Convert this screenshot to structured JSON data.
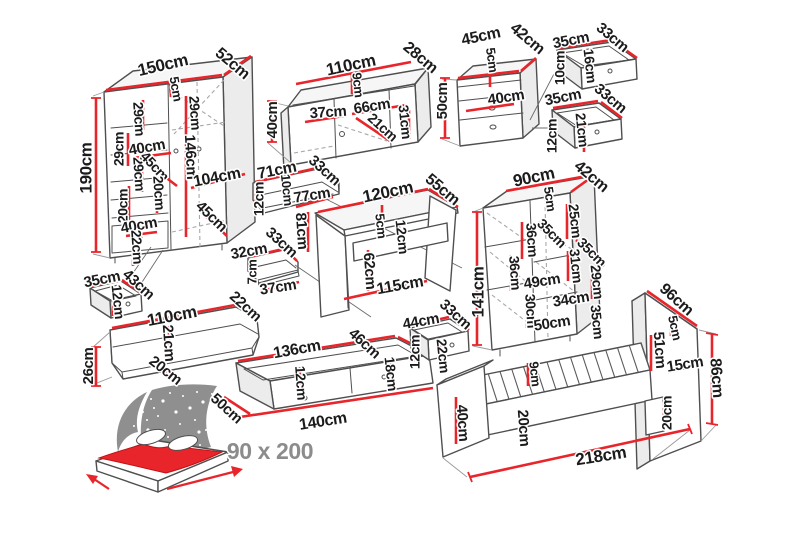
{
  "title": "Bedroom furniture set dimension diagram",
  "label_style": {
    "color": "#1b1b1b",
    "size": 15
  },
  "colors": {
    "dimension_red": "#e8252b",
    "outline": "#4f4f4f",
    "hidden_dash": "#a8a8a8",
    "star_panel": "#8f8f8f",
    "blanket_red": "#e8252b",
    "size_label_gray": "#8c8c8c",
    "background": "#ffffff"
  },
  "bed_icon": {
    "size_label": "90 x 200"
  },
  "pieces": [
    {
      "id": "wardrobe",
      "labels": [
        {
          "t": "150cm",
          "x": 163,
          "y": 66,
          "r": -13,
          "s": 17
        },
        {
          "t": "52cm",
          "x": 232,
          "y": 64,
          "r": 40,
          "s": 16
        },
        {
          "t": "5cm",
          "x": 175,
          "y": 89,
          "r": 80,
          "s": 13
        },
        {
          "t": "29cm",
          "x": 138,
          "y": 119,
          "r": 86,
          "s": 14
        },
        {
          "t": "29cm",
          "x": 194,
          "y": 113,
          "r": 86,
          "s": 14
        },
        {
          "t": "190cm",
          "x": 87,
          "y": 168,
          "r": -90,
          "s": 17
        },
        {
          "t": "29cm",
          "x": 120,
          "y": 149,
          "r": -90,
          "s": 14
        },
        {
          "t": "40cm",
          "x": 147,
          "y": 148,
          "r": -10,
          "s": 15
        },
        {
          "t": "29cm",
          "x": 138,
          "y": 174,
          "r": 86,
          "s": 14
        },
        {
          "t": "45cm",
          "x": 154,
          "y": 167,
          "r": 47,
          "s": 14
        },
        {
          "t": "20cm",
          "x": 158,
          "y": 193,
          "r": 86,
          "s": 14
        },
        {
          "t": "20cm",
          "x": 124,
          "y": 206,
          "r": -90,
          "s": 14
        },
        {
          "t": "146cm",
          "x": 190,
          "y": 157,
          "r": 87,
          "s": 15
        },
        {
          "t": "104cm",
          "x": 217,
          "y": 178,
          "r": -11,
          "s": 16
        },
        {
          "t": "40cm",
          "x": 139,
          "y": 226,
          "r": -10,
          "s": 15
        },
        {
          "t": "45cm",
          "x": 211,
          "y": 217,
          "r": 44,
          "s": 15
        },
        {
          "t": "22cm",
          "x": 136,
          "y": 247,
          "r": 86,
          "s": 14
        }
      ]
    },
    {
      "id": "tv-stand",
      "labels": [
        {
          "t": "110cm",
          "x": 351,
          "y": 66,
          "r": -12,
          "s": 17
        },
        {
          "t": "28cm",
          "x": 420,
          "y": 58,
          "r": 40,
          "s": 16
        },
        {
          "t": "40cm",
          "x": 273,
          "y": 120,
          "r": -90,
          "s": 15
        },
        {
          "t": "9cm",
          "x": 357,
          "y": 85,
          "r": 84,
          "s": 13
        },
        {
          "t": "37cm",
          "x": 328,
          "y": 113,
          "r": -4,
          "s": 15
        },
        {
          "t": "66cm",
          "x": 372,
          "y": 107,
          "r": -9,
          "s": 15
        },
        {
          "t": "21cm",
          "x": 382,
          "y": 128,
          "r": 42,
          "s": 14
        },
        {
          "t": "31cm",
          "x": 404,
          "y": 122,
          "r": 84,
          "s": 14
        }
      ]
    },
    {
      "id": "nightstand",
      "labels": [
        {
          "t": "45cm",
          "x": 481,
          "y": 37,
          "r": -12,
          "s": 16
        },
        {
          "t": "42cm",
          "x": 527,
          "y": 39,
          "r": 40,
          "s": 16
        },
        {
          "t": "5cm",
          "x": 491,
          "y": 60,
          "r": 82,
          "s": 13
        },
        {
          "t": "50cm",
          "x": 443,
          "y": 101,
          "r": -90,
          "s": 15
        },
        {
          "t": "40cm",
          "x": 506,
          "y": 98,
          "r": -9,
          "s": 15
        }
      ]
    },
    {
      "id": "drawer-top-a",
      "labels": [
        {
          "t": "35cm",
          "x": 571,
          "y": 41,
          "r": -11,
          "s": 15
        },
        {
          "t": "33cm",
          "x": 612,
          "y": 38,
          "r": 40,
          "s": 15
        },
        {
          "t": "16cm",
          "x": 589,
          "y": 66,
          "r": 84,
          "s": 14
        },
        {
          "t": "10cm",
          "x": 561,
          "y": 68,
          "r": -90,
          "s": 14
        }
      ]
    },
    {
      "id": "drawer-top-b",
      "labels": [
        {
          "t": "35cm",
          "x": 563,
          "y": 98,
          "r": -11,
          "s": 15
        },
        {
          "t": "33cm",
          "x": 610,
          "y": 99,
          "r": 40,
          "s": 15
        },
        {
          "t": "12cm",
          "x": 553,
          "y": 136,
          "r": -90,
          "s": 14
        },
        {
          "t": "21cm",
          "x": 581,
          "y": 130,
          "r": 84,
          "s": 14
        }
      ]
    },
    {
      "id": "wall-shelf-71",
      "labels": [
        {
          "t": "71cm",
          "x": 277,
          "y": 171,
          "r": -11,
          "s": 16
        },
        {
          "t": "33cm",
          "x": 324,
          "y": 171,
          "r": 42,
          "s": 15
        },
        {
          "t": "12cm",
          "x": 260,
          "y": 199,
          "r": -90,
          "s": 14
        },
        {
          "t": "10cm",
          "x": 286,
          "y": 190,
          "r": 84,
          "s": 13
        },
        {
          "t": "77cm",
          "x": 312,
          "y": 196,
          "r": -9,
          "s": 15
        }
      ]
    },
    {
      "id": "wall-shelf-32",
      "labels": [
        {
          "t": "32cm",
          "x": 249,
          "y": 252,
          "r": -10,
          "s": 15
        },
        {
          "t": "33cm",
          "x": 281,
          "y": 243,
          "r": 42,
          "s": 15
        },
        {
          "t": "7cm",
          "x": 253,
          "y": 272,
          "r": -90,
          "s": 13
        },
        {
          "t": "37cm",
          "x": 278,
          "y": 288,
          "r": -9,
          "s": 15
        }
      ]
    },
    {
      "id": "desk",
      "labels": [
        {
          "t": "120cm",
          "x": 388,
          "y": 193,
          "r": -12,
          "s": 17
        },
        {
          "t": "55cm",
          "x": 442,
          "y": 190,
          "r": 40,
          "s": 16
        },
        {
          "t": "5cm",
          "x": 380,
          "y": 226,
          "r": 84,
          "s": 13
        },
        {
          "t": "81cm",
          "x": 301,
          "y": 231,
          "r": 86,
          "s": 15
        },
        {
          "t": "12cm",
          "x": 401,
          "y": 237,
          "r": 84,
          "s": 14
        },
        {
          "t": "62cm",
          "x": 369,
          "y": 271,
          "r": 86,
          "s": 15
        },
        {
          "t": "115cm",
          "x": 400,
          "y": 286,
          "r": -10,
          "s": 16
        }
      ]
    },
    {
      "id": "bookcase",
      "labels": [
        {
          "t": "90cm",
          "x": 534,
          "y": 178,
          "r": -12,
          "s": 17
        },
        {
          "t": "42cm",
          "x": 591,
          "y": 177,
          "r": 40,
          "s": 16
        },
        {
          "t": "5cm",
          "x": 549,
          "y": 199,
          "r": 82,
          "s": 13
        },
        {
          "t": "141cm",
          "x": 479,
          "y": 292,
          "r": -90,
          "s": 17
        },
        {
          "t": "25cm",
          "x": 574,
          "y": 221,
          "r": 84,
          "s": 14
        },
        {
          "t": "36cm",
          "x": 531,
          "y": 240,
          "r": 86,
          "s": 14
        },
        {
          "t": "35cm",
          "x": 551,
          "y": 234,
          "r": 45,
          "s": 14
        },
        {
          "t": "35cm",
          "x": 591,
          "y": 253,
          "r": 45,
          "s": 14
        },
        {
          "t": "31cm",
          "x": 575,
          "y": 266,
          "r": 84,
          "s": 14
        },
        {
          "t": "36cm",
          "x": 514,
          "y": 273,
          "r": 86,
          "s": 14
        },
        {
          "t": "29cm",
          "x": 596,
          "y": 282,
          "r": 84,
          "s": 14
        },
        {
          "t": "49cm",
          "x": 542,
          "y": 282,
          "r": -9,
          "s": 15
        },
        {
          "t": "30cm",
          "x": 530,
          "y": 311,
          "r": 86,
          "s": 14
        },
        {
          "t": "34cm",
          "x": 571,
          "y": 300,
          "r": -9,
          "s": 15
        },
        {
          "t": "35cm",
          "x": 596,
          "y": 322,
          "r": 84,
          "s": 14
        },
        {
          "t": "50cm",
          "x": 552,
          "y": 324,
          "r": -9,
          "s": 15
        }
      ]
    },
    {
      "id": "drawer-35-43",
      "labels": [
        {
          "t": "35cm",
          "x": 102,
          "y": 280,
          "r": -11,
          "s": 15
        },
        {
          "t": "43cm",
          "x": 138,
          "y": 285,
          "r": 42,
          "s": 15
        },
        {
          "t": "12cm",
          "x": 117,
          "y": 302,
          "r": 84,
          "s": 14
        }
      ]
    },
    {
      "id": "wall-shelf-110",
      "labels": [
        {
          "t": "110cm",
          "x": 172,
          "y": 317,
          "r": -11,
          "s": 17
        },
        {
          "t": "22cm",
          "x": 245,
          "y": 307,
          "r": 42,
          "s": 15
        },
        {
          "t": "21cm",
          "x": 168,
          "y": 343,
          "r": 86,
          "s": 15
        },
        {
          "t": "20cm",
          "x": 165,
          "y": 371,
          "r": 38,
          "s": 15
        },
        {
          "t": "26cm",
          "x": 89,
          "y": 366,
          "r": -90,
          "s": 15
        }
      ]
    },
    {
      "id": "underbed-drawer-136",
      "labels": [
        {
          "t": "136cm",
          "x": 297,
          "y": 350,
          "r": -10,
          "s": 16
        },
        {
          "t": "46cm",
          "x": 364,
          "y": 344,
          "r": 42,
          "s": 15
        },
        {
          "t": "12cm",
          "x": 300,
          "y": 383,
          "r": 86,
          "s": 14
        },
        {
          "t": "18cm",
          "x": 390,
          "y": 374,
          "r": 84,
          "s": 14
        },
        {
          "t": "50cm",
          "x": 226,
          "y": 409,
          "r": 42,
          "s": 15
        },
        {
          "t": "140cm",
          "x": 323,
          "y": 422,
          "r": -9,
          "s": 16
        }
      ]
    },
    {
      "id": "drawer-44",
      "labels": [
        {
          "t": "44cm",
          "x": 421,
          "y": 322,
          "r": -10,
          "s": 15
        },
        {
          "t": "33cm",
          "x": 455,
          "y": 315,
          "r": 42,
          "s": 15
        },
        {
          "t": "12cm",
          "x": 416,
          "y": 352,
          "r": -90,
          "s": 14
        },
        {
          "t": "22cm",
          "x": 442,
          "y": 356,
          "r": 84,
          "s": 14
        }
      ]
    },
    {
      "id": "bed",
      "labels": [
        {
          "t": "9cm",
          "x": 534,
          "y": 374,
          "r": 84,
          "s": 13
        },
        {
          "t": "40cm",
          "x": 462,
          "y": 423,
          "r": 86,
          "s": 15
        },
        {
          "t": "20cm",
          "x": 523,
          "y": 428,
          "r": 86,
          "s": 15
        },
        {
          "t": "20cm",
          "x": 668,
          "y": 413,
          "r": -90,
          "s": 14
        },
        {
          "t": "51cm",
          "x": 659,
          "y": 350,
          "r": 86,
          "s": 15
        },
        {
          "t": "5cm",
          "x": 674,
          "y": 328,
          "r": 78,
          "s": 13
        },
        {
          "t": "96cm",
          "x": 676,
          "y": 300,
          "r": 42,
          "s": 16
        },
        {
          "t": "15cm",
          "x": 685,
          "y": 365,
          "r": -9,
          "s": 15
        },
        {
          "t": "86cm",
          "x": 716,
          "y": 378,
          "r": 86,
          "s": 16
        },
        {
          "t": "218cm",
          "x": 601,
          "y": 457,
          "r": -9,
          "s": 17
        }
      ]
    },
    {
      "id": "bed-icon",
      "labels": [
        {
          "t": "90 x 200",
          "x": 270,
          "y": 453,
          "r": 0,
          "s": 23,
          "c": "#8c8c8c"
        }
      ]
    }
  ]
}
